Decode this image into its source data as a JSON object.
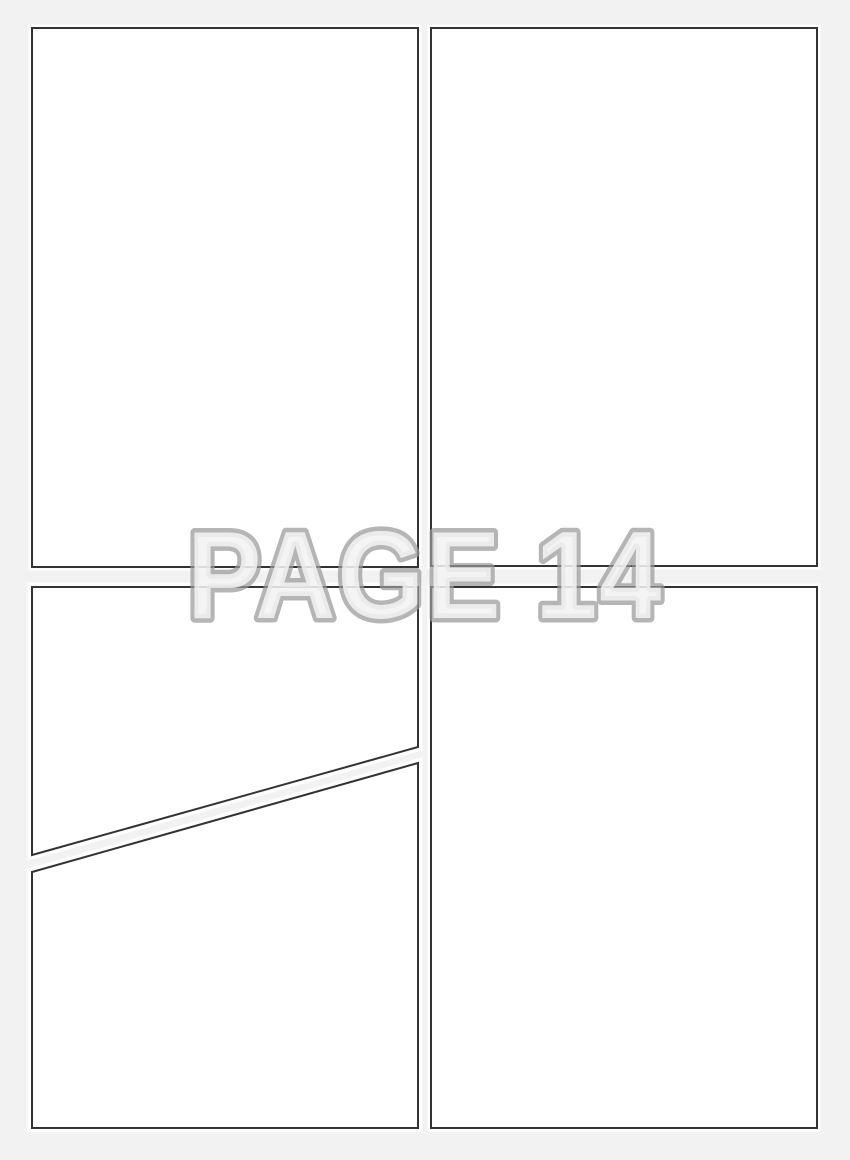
{
  "page": {
    "watermark": {
      "label": "PAGE 14"
    },
    "colors": {
      "background": "#f2f2f3",
      "panel_fill": "#ffffff",
      "panel_border": "#333333",
      "watermark_stroke": "#999999",
      "watermark_fill": "#f2f2f2"
    },
    "panels": [
      {
        "id": "panel-top-left"
      },
      {
        "id": "panel-top-right"
      },
      {
        "id": "panel-bottom-left-upper"
      },
      {
        "id": "panel-bottom-left-lower"
      },
      {
        "id": "panel-bottom-right"
      }
    ]
  }
}
